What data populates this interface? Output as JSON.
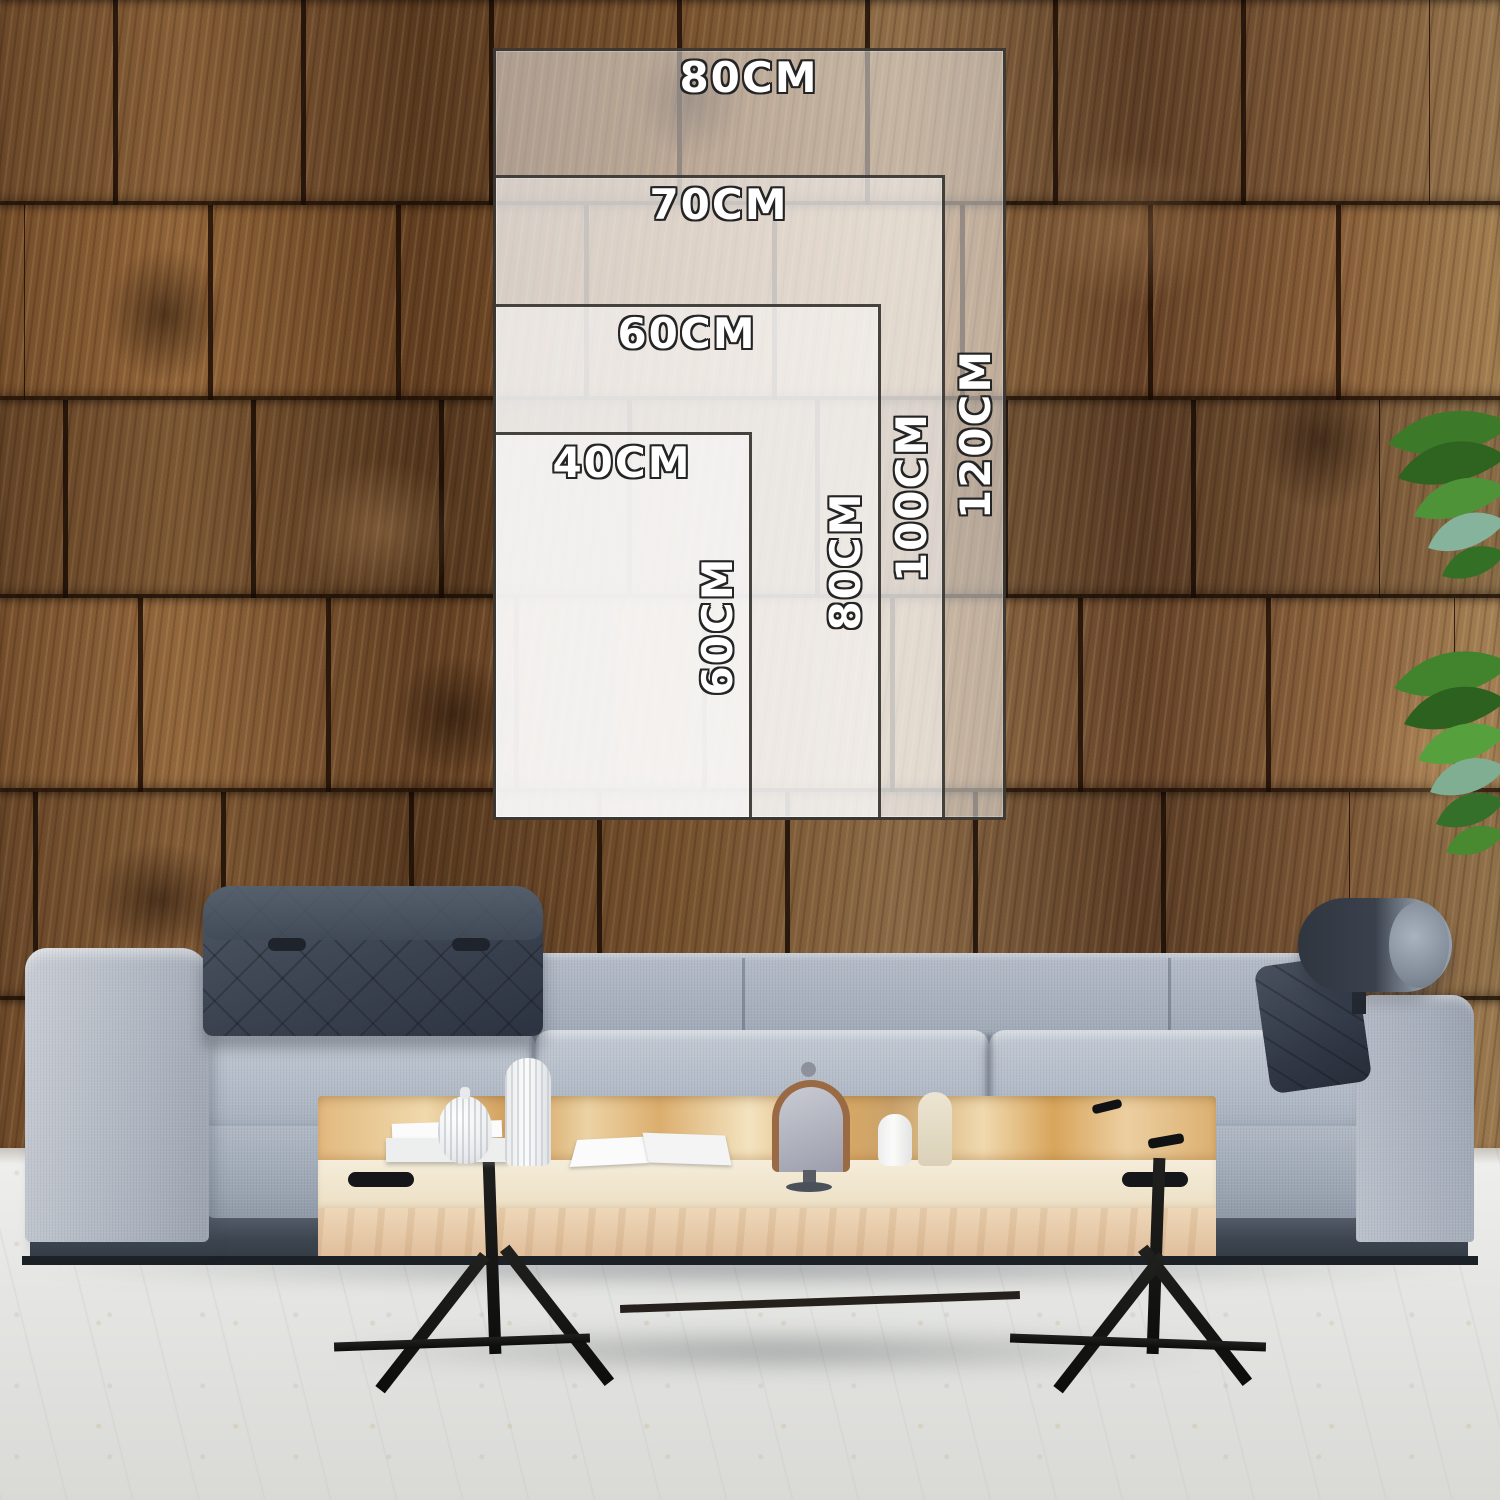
{
  "size_guide": {
    "sizes": [
      {
        "id": "80x120",
        "width_label": "80CM",
        "height_label": "120CM"
      },
      {
        "id": "70x100",
        "width_label": "70CM",
        "height_label": "100CM"
      },
      {
        "id": "60x80",
        "width_label": "60CM",
        "height_label": "80CM"
      },
      {
        "id": "40x60",
        "width_label": "40CM",
        "height_label": "60CM"
      }
    ]
  },
  "palette": {
    "wall_brown": "#7a5433",
    "wall_seam": "#1c0e04",
    "sofa_gray": "#aeb6c2",
    "headrest_dark": "#3a4250",
    "table_wood": "#e3c392",
    "table_cream": "#f2ead6",
    "floor": "#e9e9e7",
    "leaf_green": "#4c8b33",
    "overlay_fill": "rgba(252,252,251,0.5)",
    "overlay_border": "#2e2a26",
    "label_text": "#ffffff",
    "label_outline": "#242424"
  }
}
